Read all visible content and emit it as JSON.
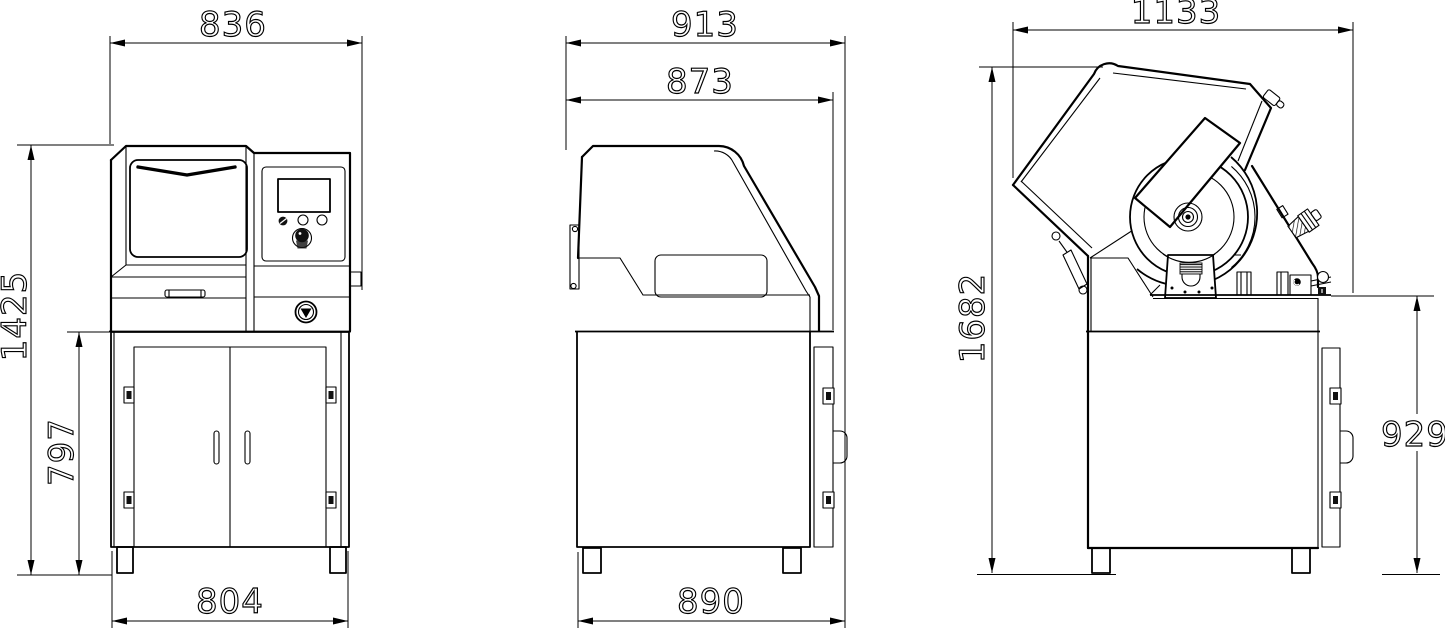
{
  "page": {
    "background": "#ffffff",
    "line_color": "#000000"
  },
  "views": {
    "front": {
      "dims": {
        "overall_width": "836",
        "overall_height": "1425",
        "cabinet_height": "797",
        "base_width": "804"
      }
    },
    "side_closed": {
      "dims": {
        "overall_depth": "913",
        "hood_depth": "873",
        "base_depth": "890"
      }
    },
    "side_open": {
      "dims": {
        "overall_depth": "1133",
        "overall_height": "1682",
        "table_height": "929"
      }
    }
  }
}
